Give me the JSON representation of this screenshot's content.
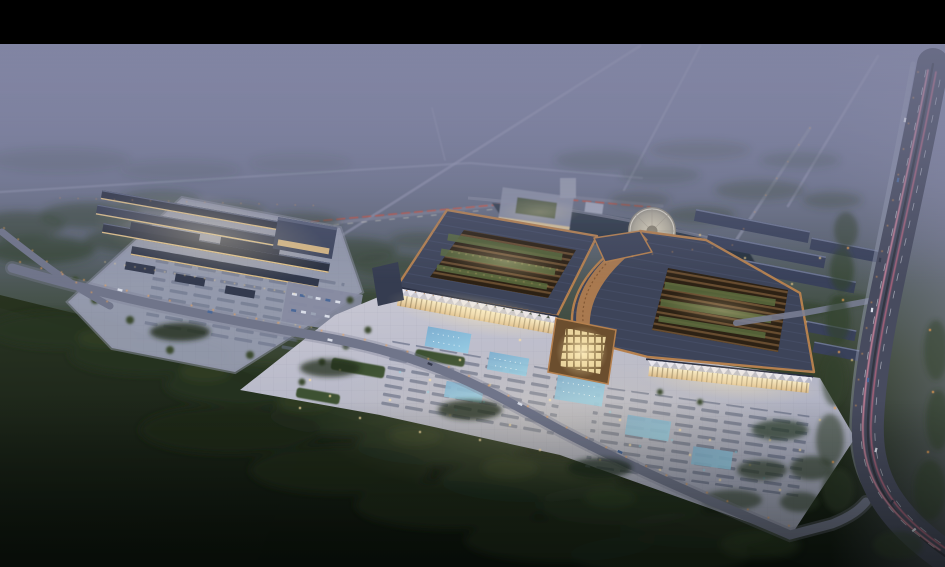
{
  "scene": {
    "type": "architectural-aerial-rendering",
    "time_of_day": "dusk",
    "description": "Aerial dusk rendering of a large traditional-style trade market complex: two grand courtyard halls with copper-trimmed dark roofs and glowing facades, a bright front plaza with lit fountains and parking rows, a secondary market complex with long shop rows to the west, an office block and pond with a circular island plaza to the north, warehouse rows to the east, dark forest and fields in the foreground, and a multi-lane highway with pink light trails on the east edge. Black letterbox bar across the top."
  },
  "canvas": {
    "width": 945,
    "height": 567,
    "letterbox_top": 44
  },
  "palette": {
    "black": "#000000",
    "sky0": "#8286a4",
    "sky1": "#8185a3",
    "sky2": "#7a7f9c",
    "sky3": "#6f758e",
    "sky4": "#5d6574",
    "sky5": "#48544e",
    "sky6": "#35412d",
    "sky7": "#202b1a",
    "sky8": "#0e150f",
    "mist": "#8184a2",
    "road_faint": "#9a9db6",
    "road_mid": "#70758a",
    "highway": "#474b5e",
    "trail_pink": "#e08ca4",
    "trail_deep": "#c96a84",
    "trail_red": "#d05038",
    "light_orange": "#f2a355",
    "light_warm_dot": "#ffe3a6",
    "tree": "#31402b",
    "forest_top": "#2a3524",
    "forest_bottom": "#0b110b",
    "field_top": "#28331f",
    "field_bottom": "#101810",
    "plaza_light": "#c9c8d4",
    "plaza_dark": "#a3a7ba",
    "lot": "#9aa0b4",
    "row_roof": "#2a3040",
    "row_lit": "#ecca8c",
    "roof": "#3d4459",
    "copper": "#b5804e",
    "courtyard": "#2c2114",
    "rib": "#6f5233",
    "green_roof": "#5a6b3e",
    "facade_top": "#f7ecc9",
    "facade_bottom": "#d9b887",
    "canopy_white": "#e9e7ef",
    "pool_top": "#79add0",
    "pool_bottom": "#93cde6",
    "pond_top": "#343f4e",
    "pond_bottom": "#232d3a",
    "circle_plaza": "#cfcabc",
    "office": "#8d92a6",
    "car_white": "#d9dde8",
    "car_blue": "#4a6898"
  },
  "parts": {
    "main_hall_west": "grand courtyard hall with open roof",
    "main_hall_east": "grand courtyard hall with curved eave",
    "entrance_gate": "central lit gate pavilion",
    "front_plaza": "illuminated plaza with fountains and parking",
    "west_complex": "row-building market with parking lot",
    "north_office": "office block with green courtyard",
    "pond": "landscape pond",
    "island_plaza": "circular island plaza",
    "warehouse_rows": "east warehouse rows",
    "east_highway": "multi-lane highway with light trails",
    "front_road": "tree-lined access road",
    "forest": "foreground forest and fields"
  }
}
